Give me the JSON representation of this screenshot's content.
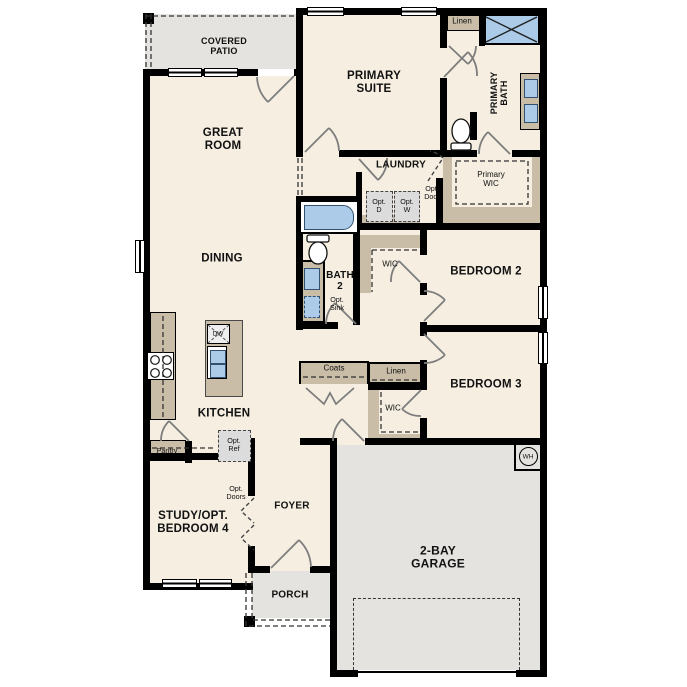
{
  "palette": {
    "floor": "#f5eee1",
    "outdoor": "#e4e3df",
    "closet_tan": "#c9bda7",
    "fixture_blue": "#abcbe9",
    "option_gray": "#dcdcdc",
    "wall": "#000000",
    "door_arc": "#7d7d7d"
  },
  "rooms": {
    "covered_patio": "COVERED\nPATIO",
    "great_room": "GREAT\nROOM",
    "dining": "DINING",
    "kitchen": "KITCHEN",
    "study": "STUDY/OPT.\nBEDROOM 4",
    "foyer": "FOYER",
    "porch": "PORCH",
    "garage": "2-BAY\nGARAGE",
    "primary_suite": "PRIMARY\nSUITE",
    "primary_bath": "PRIMARY\nBATH",
    "primary_wic": "Primary\nWIC",
    "laundry": "LAUNDRY",
    "bath2": "BATH\n2",
    "bedroom2": "BEDROOM 2",
    "bedroom3": "BEDROOM 3"
  },
  "closets": {
    "linen_bath": "Linen",
    "linen_hall": "Linen",
    "coats": "Coats",
    "pantry": "Pantry",
    "wic_bed2": "WIC",
    "wic_bed3": "WIC"
  },
  "options": {
    "opt_dryer": "Opt.\nD",
    "opt_washer": "Opt.\nW",
    "opt_door": "Opt.\nDoor",
    "opt_sink": "Opt.\nSink",
    "opt_ref": "Opt.\nRef",
    "opt_doors": "Opt.\nDoors"
  },
  "appliances": {
    "dishwasher": "DW",
    "water_heater": "WH"
  }
}
